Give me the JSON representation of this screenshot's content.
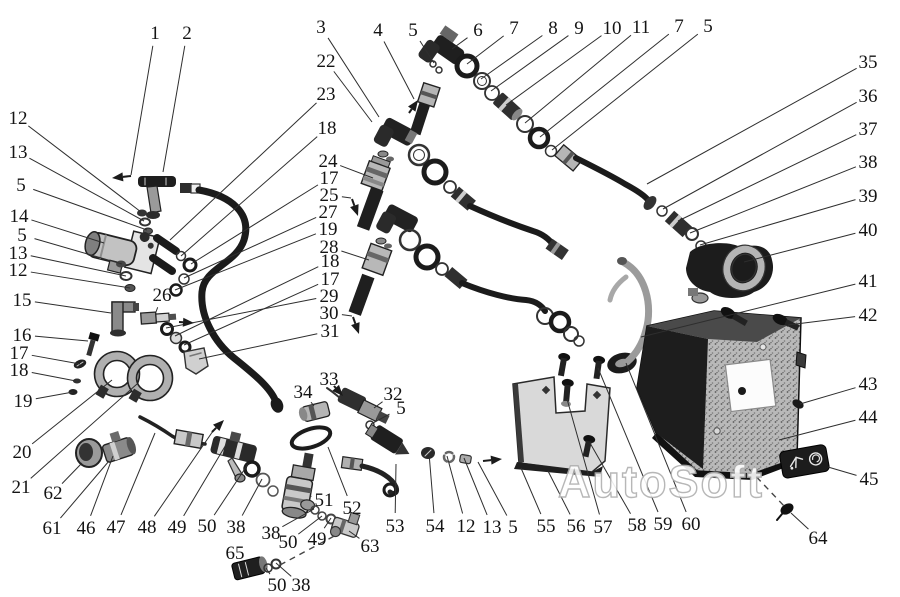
{
  "watermark": "AutoSoft",
  "colors": {
    "ink": "#1b1b1b",
    "leader_line": "#2e2e2e",
    "paper": "#ffffff",
    "metal_light": "#c9c9c9",
    "metal_mid": "#8e8e8e",
    "tank_gray": "#b9b9b9",
    "bracket_gray": "#d9d9d9",
    "watermark_stroke": "#b0b0b0"
  },
  "callouts": [
    {
      "n": "1",
      "x": 155,
      "y": 33,
      "tx": 131,
      "ty": 175
    },
    {
      "n": "2",
      "x": 187,
      "y": 33,
      "tx": 163,
      "ty": 172
    },
    {
      "n": "3",
      "x": 321,
      "y": 27,
      "tx": 379,
      "ty": 117
    },
    {
      "n": "22",
      "x": 326,
      "y": 61,
      "tx": 372,
      "ty": 122
    },
    {
      "n": "4",
      "x": 378,
      "y": 30,
      "tx": 414,
      "ty": 99
    },
    {
      "n": "5",
      "x": 413,
      "y": 30,
      "tx": 434,
      "ty": 63
    },
    {
      "n": "6",
      "x": 478,
      "y": 30,
      "tx": 452,
      "ty": 49
    },
    {
      "n": "7",
      "x": 514,
      "y": 28,
      "tx": 467,
      "ty": 64
    },
    {
      "n": "8",
      "x": 553,
      "y": 28,
      "tx": 481,
      "ty": 79
    },
    {
      "n": "9",
      "x": 579,
      "y": 28,
      "tx": 491,
      "ty": 91
    },
    {
      "n": "10",
      "x": 612,
      "y": 28,
      "tx": 506,
      "ty": 105
    },
    {
      "n": "11",
      "x": 641,
      "y": 27,
      "tx": 525,
      "ty": 123
    },
    {
      "n": "7",
      "x": 679,
      "y": 26,
      "tx": 540,
      "ty": 137
    },
    {
      "n": "5",
      "x": 708,
      "y": 26,
      "tx": 552,
      "ty": 150
    },
    {
      "n": "35",
      "x": 868,
      "y": 62,
      "tx": 647,
      "ty": 184
    },
    {
      "n": "36",
      "x": 868,
      "y": 96,
      "tx": 663,
      "ty": 209
    },
    {
      "n": "37",
      "x": 868,
      "y": 129,
      "tx": 678,
      "ty": 221
    },
    {
      "n": "38",
      "x": 868,
      "y": 162,
      "tx": 690,
      "ty": 233
    },
    {
      "n": "39",
      "x": 868,
      "y": 196,
      "tx": 700,
      "ty": 245
    },
    {
      "n": "40",
      "x": 868,
      "y": 230,
      "tx": 744,
      "ty": 262
    },
    {
      "n": "41",
      "x": 868,
      "y": 281,
      "tx": 641,
      "ty": 337
    },
    {
      "n": "42",
      "x": 868,
      "y": 315,
      "tx": 788,
      "ty": 325
    },
    {
      "n": "43",
      "x": 868,
      "y": 384,
      "tx": 800,
      "ty": 404
    },
    {
      "n": "44",
      "x": 868,
      "y": 417,
      "tx": 779,
      "ty": 440
    },
    {
      "n": "45",
      "x": 869,
      "y": 479,
      "tx": 828,
      "ty": 467
    },
    {
      "n": "64",
      "x": 818,
      "y": 538,
      "tx": 791,
      "ty": 513
    },
    {
      "n": "12",
      "x": 18,
      "y": 118,
      "tx": 141,
      "ty": 212
    },
    {
      "n": "13",
      "x": 18,
      "y": 152,
      "tx": 144,
      "ty": 221
    },
    {
      "n": "5",
      "x": 21,
      "y": 185,
      "tx": 147,
      "ty": 230
    },
    {
      "n": "14",
      "x": 19,
      "y": 216,
      "tx": 104,
      "ty": 243
    },
    {
      "n": "5",
      "x": 22,
      "y": 235,
      "tx": 122,
      "ty": 264
    },
    {
      "n": "13",
      "x": 18,
      "y": 253,
      "tx": 126,
      "ty": 276
    },
    {
      "n": "12",
      "x": 18,
      "y": 270,
      "tx": 130,
      "ty": 288
    },
    {
      "n": "15",
      "x": 22,
      "y": 300,
      "tx": 111,
      "ty": 313
    },
    {
      "n": "16",
      "x": 22,
      "y": 335,
      "tx": 88,
      "ty": 341
    },
    {
      "n": "17",
      "x": 19,
      "y": 353,
      "tx": 80,
      "ty": 364
    },
    {
      "n": "18",
      "x": 19,
      "y": 370,
      "tx": 76,
      "ty": 381
    },
    {
      "n": "19",
      "x": 23,
      "y": 401,
      "tx": 73,
      "ty": 392
    },
    {
      "n": "20",
      "x": 22,
      "y": 452,
      "tx": 112,
      "ty": 380
    },
    {
      "n": "21",
      "x": 21,
      "y": 487,
      "tx": 137,
      "ty": 384
    },
    {
      "n": "62",
      "x": 53,
      "y": 493,
      "tx": 82,
      "ty": 463
    },
    {
      "n": "61",
      "x": 52,
      "y": 528,
      "tx": 109,
      "ty": 461
    },
    {
      "n": "23",
      "x": 326,
      "y": 94,
      "tx": 170,
      "ty": 240
    },
    {
      "n": "18",
      "x": 327,
      "y": 128,
      "tx": 181,
      "ty": 256
    },
    {
      "n": "24",
      "x": 328,
      "y": 161,
      "tx": 373,
      "ty": 178
    },
    {
      "n": "17",
      "x": 329,
      "y": 178,
      "tx": 191,
      "ty": 264
    },
    {
      "n": "25",
      "x": 329,
      "y": 195,
      "tx": 351,
      "ty": 198
    },
    {
      "n": "27",
      "x": 328,
      "y": 212,
      "tx": 184,
      "ty": 278
    },
    {
      "n": "19",
      "x": 328,
      "y": 229,
      "tx": 175,
      "ty": 290
    },
    {
      "n": "28",
      "x": 329,
      "y": 247,
      "tx": 369,
      "ty": 260
    },
    {
      "n": "18",
      "x": 330,
      "y": 261,
      "tx": 175,
      "ty": 336
    },
    {
      "n": "17",
      "x": 330,
      "y": 279,
      "tx": 184,
      "ty": 345
    },
    {
      "n": "29",
      "x": 329,
      "y": 296,
      "tx": 166,
      "ty": 328
    },
    {
      "n": "30",
      "x": 329,
      "y": 313,
      "tx": 352,
      "ty": 316
    },
    {
      "n": "31",
      "x": 330,
      "y": 331,
      "tx": 199,
      "ty": 359
    },
    {
      "n": "26",
      "x": 162,
      "y": 295,
      "tx": 156,
      "ty": 312
    },
    {
      "n": "33",
      "x": 329,
      "y": 379,
      "tx": 334,
      "ty": 386
    },
    {
      "n": "34",
      "x": 303,
      "y": 392,
      "tx": 314,
      "ty": 406
    },
    {
      "n": "32",
      "x": 393,
      "y": 394,
      "tx": 374,
      "ty": 408
    },
    {
      "n": "5",
      "x": 401,
      "y": 408,
      "tx": 371,
      "ty": 424
    },
    {
      "n": "46",
      "x": 86,
      "y": 528,
      "tx": 113,
      "ty": 456
    },
    {
      "n": "47",
      "x": 116,
      "y": 527,
      "tx": 155,
      "ty": 433
    },
    {
      "n": "48",
      "x": 147,
      "y": 527,
      "tx": 213,
      "ty": 431
    },
    {
      "n": "49",
      "x": 177,
      "y": 527,
      "tx": 227,
      "ty": 443
    },
    {
      "n": "50",
      "x": 207,
      "y": 526,
      "tx": 248,
      "ty": 464
    },
    {
      "n": "38",
      "x": 236,
      "y": 527,
      "tx": 262,
      "ty": 479
    },
    {
      "n": "38",
      "x": 271,
      "y": 533,
      "tx": 314,
      "ty": 509
    },
    {
      "n": "50",
      "x": 288,
      "y": 542,
      "tx": 322,
      "ty": 516
    },
    {
      "n": "49",
      "x": 317,
      "y": 539,
      "tx": 331,
      "ty": 518
    },
    {
      "n": "63",
      "x": 370,
      "y": 546,
      "tx": 349,
      "ty": 531
    },
    {
      "n": "65",
      "x": 235,
      "y": 553,
      "tx": 247,
      "ty": 562
    },
    {
      "n": "50",
      "x": 277,
      "y": 585,
      "tx": 266,
      "ty": 568
    },
    {
      "n": "38",
      "x": 301,
      "y": 585,
      "tx": 276,
      "ty": 563
    },
    {
      "n": "51",
      "x": 324,
      "y": 500,
      "tx": 310,
      "ty": 496
    },
    {
      "n": "52",
      "x": 352,
      "y": 508,
      "tx": 328,
      "ty": 447
    },
    {
      "n": "53",
      "x": 395,
      "y": 526,
      "tx": 396,
      "ty": 464
    },
    {
      "n": "54",
      "x": 435,
      "y": 526,
      "tx": 429,
      "ty": 453
    },
    {
      "n": "12",
      "x": 466,
      "y": 526,
      "tx": 447,
      "ty": 456
    },
    {
      "n": "13",
      "x": 492,
      "y": 527,
      "tx": 464,
      "ty": 458
    },
    {
      "n": "5",
      "x": 513,
      "y": 527,
      "tx": 478,
      "ty": 462
    },
    {
      "n": "55",
      "x": 546,
      "y": 526,
      "tx": 521,
      "ty": 468
    },
    {
      "n": "56",
      "x": 576,
      "y": 526,
      "tx": 548,
      "ty": 471
    },
    {
      "n": "57",
      "x": 603,
      "y": 527,
      "tx": 567,
      "ty": 399
    },
    {
      "n": "58",
      "x": 637,
      "y": 525,
      "tx": 590,
      "ty": 443
    },
    {
      "n": "59",
      "x": 663,
      "y": 524,
      "tx": 598,
      "ty": 368
    },
    {
      "n": "60",
      "x": 691,
      "y": 524,
      "tx": 626,
      "ty": 363
    }
  ],
  "direction_arrows": [
    {
      "x1": 131,
      "y1": 176,
      "x2": 112,
      "y2": 178
    },
    {
      "x1": 409,
      "y1": 113,
      "x2": 418,
      "y2": 100
    },
    {
      "x1": 352,
      "y1": 199,
      "x2": 358,
      "y2": 216
    },
    {
      "x1": 353,
      "y1": 317,
      "x2": 359,
      "y2": 334
    },
    {
      "x1": 179,
      "y1": 322,
      "x2": 194,
      "y2": 323
    },
    {
      "x1": 212,
      "y1": 432,
      "x2": 224,
      "y2": 420
    },
    {
      "x1": 483,
      "y1": 461,
      "x2": 502,
      "y2": 459
    },
    {
      "x1": 334,
      "y1": 386,
      "x2": 343,
      "y2": 396
    }
  ],
  "dashed_lines": [
    {
      "x1": 749,
      "y1": 469,
      "x2": 785,
      "y2": 507
    },
    {
      "x1": 280,
      "y1": 565,
      "x2": 338,
      "y2": 534
    }
  ]
}
